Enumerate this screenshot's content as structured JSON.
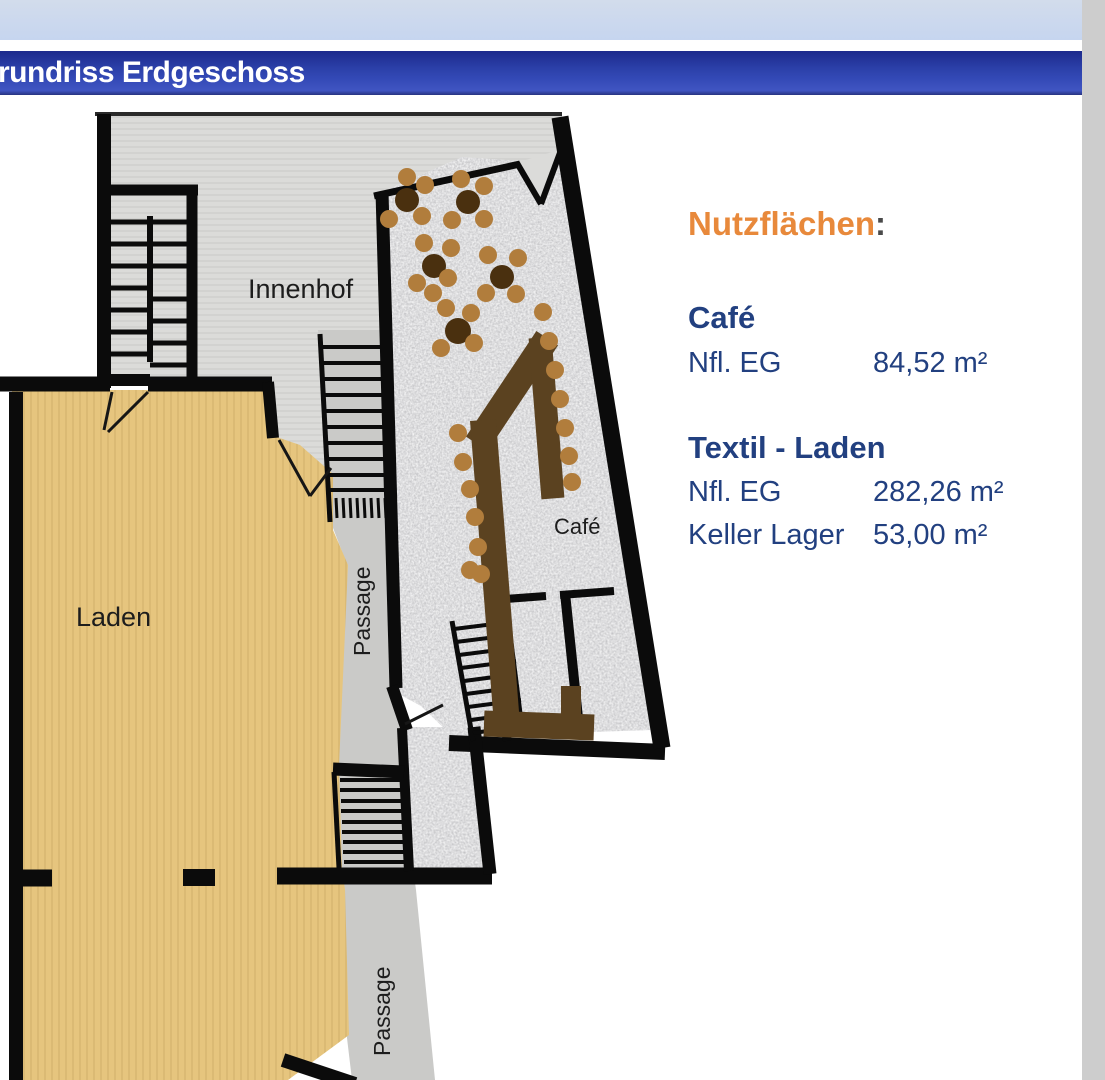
{
  "header": {
    "title": "rundriss Erdgeschoss"
  },
  "plan": {
    "labels": {
      "innenhof": "Innenhof",
      "laden": "Laden",
      "passage_upper": "Passage",
      "passage_lower": "Passage",
      "cafe": "Café"
    },
    "colors": {
      "wall": "#0b0b0b",
      "laden_fill": "#e6c57e",
      "courtyard_fill": "#dbdbd9",
      "passage_fill": "#cacac8",
      "bar_counter": "#5b4220",
      "table": "#4a300f",
      "chair": "#b17d3c"
    }
  },
  "info": {
    "heading": "Nutzflächen",
    "heading_colon": ":",
    "accent_color": "#e8893b",
    "text_color": "#224080",
    "sections": [
      {
        "title": "Café",
        "rows": [
          {
            "label": "Nfl. EG",
            "value": "84,52 m²"
          }
        ]
      },
      {
        "title": "Textil - Laden",
        "rows": [
          {
            "label": "Nfl. EG",
            "value": "282,26 m²"
          },
          {
            "label": "Keller Lager",
            "value": "53,00 m²"
          }
        ]
      }
    ]
  }
}
